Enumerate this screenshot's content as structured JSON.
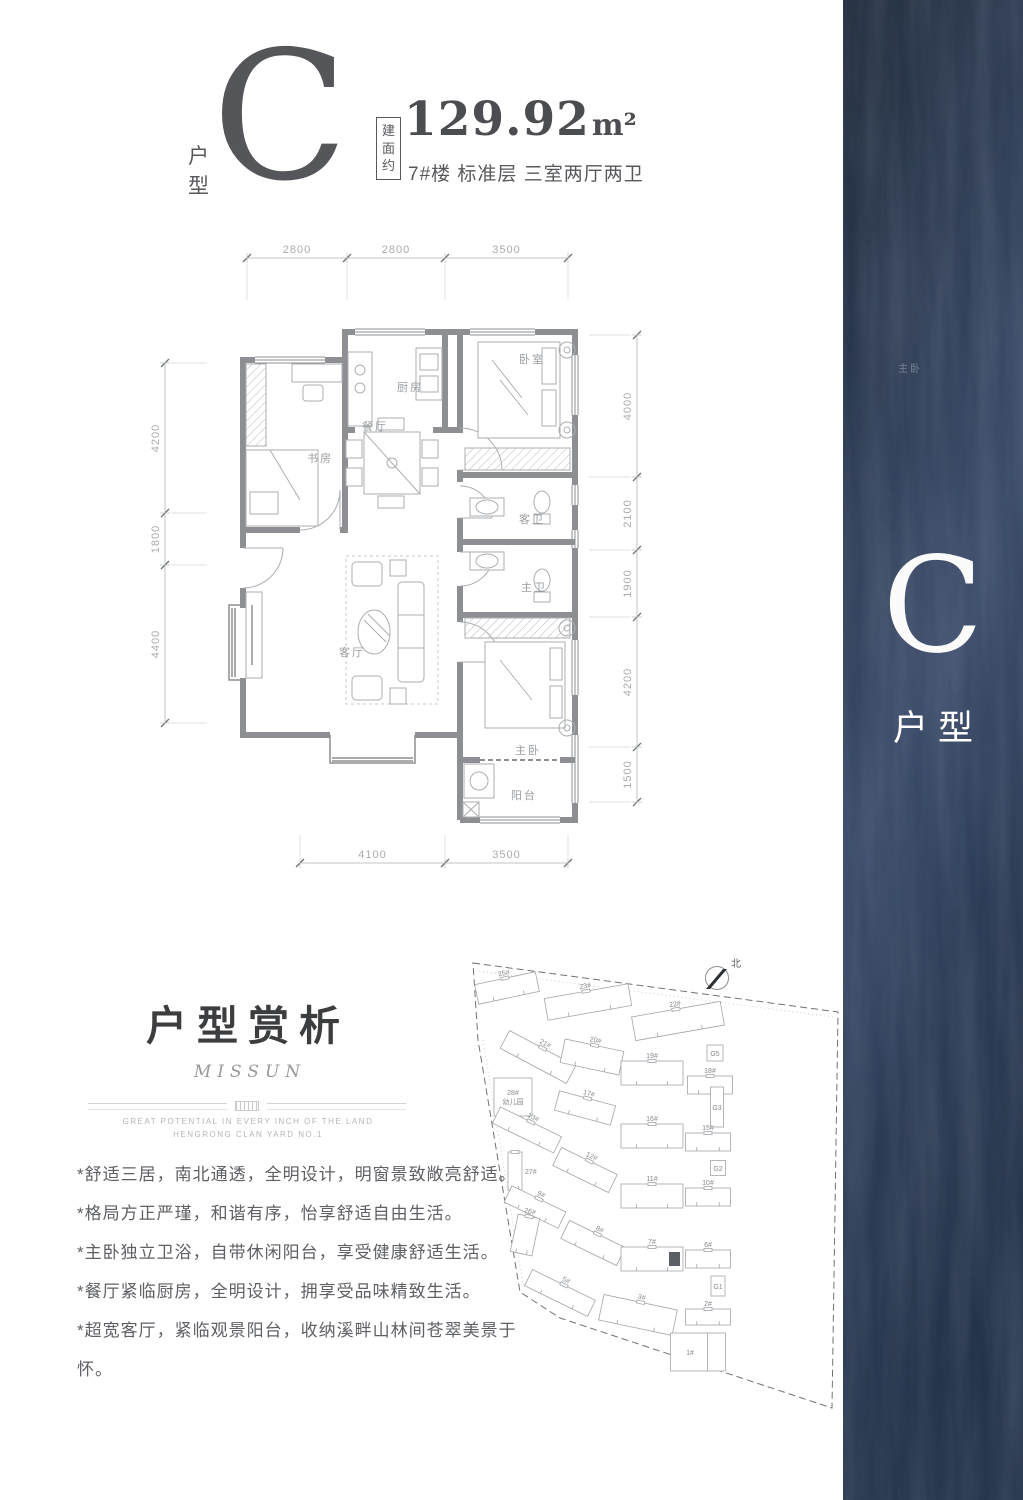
{
  "header": {
    "unit_type_label": "户型",
    "unit_letter": "C",
    "area_box_label": "建面约",
    "area_value": "129.92",
    "area_unit": "m²",
    "building_info": "7#楼 标准层 三室两厅两卫"
  },
  "floor_plan": {
    "rooms": [
      {
        "name": "study",
        "label": "书房",
        "x": 180,
        "y": 232
      },
      {
        "name": "dining",
        "label": "餐厅",
        "x": 235,
        "y": 200
      },
      {
        "name": "kitchen",
        "label": "厨房",
        "x": 270,
        "y": 161
      },
      {
        "name": "bedroom",
        "label": "卧室",
        "x": 392,
        "y": 133
      },
      {
        "name": "guest-bath",
        "label": "客卫",
        "x": 392,
        "y": 293
      },
      {
        "name": "master-bath",
        "label": "主卫",
        "x": 394,
        "y": 361
      },
      {
        "name": "living",
        "label": "客厅",
        "x": 212,
        "y": 426
      },
      {
        "name": "master-bedroom",
        "label": "主卧",
        "x": 388,
        "y": 524
      },
      {
        "name": "balcony",
        "label": "阳台",
        "x": 384,
        "y": 569
      }
    ],
    "dimensions": {
      "top": {
        "orientation": "h",
        "pos": 28,
        "ticks": [
          107,
          207,
          305,
          428
        ],
        "labels": [
          "2800",
          "2800",
          "3500"
        ],
        "ext": 42
      },
      "bottom": {
        "orientation": "h",
        "pos": 633,
        "ticks": [
          160,
          305,
          428
        ],
        "labels": [
          "4100",
          "3500"
        ],
        "ext": -28
      },
      "left": {
        "orientation": "v",
        "pos": 25,
        "ticks": [
          133,
          283,
          335,
          493
        ],
        "labels": [
          "4200",
          "1800",
          "4400"
        ],
        "ext": 42
      },
      "right": {
        "orientation": "v",
        "pos": 497,
        "ticks": [
          105,
          247,
          320,
          387,
          517,
          572
        ],
        "labels": [
          "4000",
          "2100",
          "1900",
          "4200",
          "1500"
        ],
        "ext": -48
      }
    }
  },
  "appreciation": {
    "title": "户型赏析",
    "brand": "MISSUN",
    "tagline1": "GREAT POTENTIAL IN EVERY INCH OF THE LAND",
    "tagline2": "HENGRONG CLAN YARD NO.1",
    "bullets": [
      "*舒适三居，南北通透，全明设计，明窗景致敞亮舒适。",
      "*格局方正严瑾，和谐有序，怡享舒适自由生活。",
      "*主卧独立卫浴，自带休闲阳台，享受健康舒适生活。",
      "*餐厅紧临厨房，全明设计，拥享受品味精致生活。",
      "*超宽客厅，紧临观景阳台，收纳溪畔山林间苍翠美景于怀。"
    ]
  },
  "site_plan": {
    "north_label": "北",
    "buildings": [
      {
        "label": "25#",
        "cx": 52,
        "cy": 43,
        "w": 62,
        "h": 20,
        "rot": -12
      },
      {
        "label": "23#",
        "cx": 133,
        "cy": 57,
        "w": 85,
        "h": 22,
        "rot": -10
      },
      {
        "label": "22#",
        "cx": 223,
        "cy": 76,
        "w": 90,
        "h": 24,
        "rot": -10
      },
      {
        "label": "G5",
        "cx": 260,
        "cy": 108,
        "w": 16,
        "h": 16,
        "rot": 0,
        "kind": "box"
      },
      {
        "label": "21#",
        "cx": 83,
        "cy": 112,
        "w": 75,
        "h": 20,
        "rot": 28
      },
      {
        "label": "20#",
        "cx": 137,
        "cy": 112,
        "w": 60,
        "h": 24,
        "rot": 12
      },
      {
        "label": "19#",
        "cx": 197,
        "cy": 128,
        "w": 62,
        "h": 24,
        "rot": 0
      },
      {
        "label": "18#",
        "cx": 255,
        "cy": 140,
        "w": 45,
        "h": 18,
        "rot": 0
      },
      {
        "label": "28#",
        "label2": "幼儿园",
        "cx": 58,
        "cy": 152,
        "w": 38,
        "h": 38,
        "rot": 0,
        "kind": "block"
      },
      {
        "label": "17#",
        "cx": 130,
        "cy": 163,
        "w": 58,
        "h": 20,
        "rot": 15
      },
      {
        "label": "G3",
        "cx": 262,
        "cy": 162,
        "w": 13,
        "h": 40,
        "rot": 0,
        "kind": "box"
      },
      {
        "label": "13#",
        "cx": 72,
        "cy": 185,
        "w": 68,
        "h": 18,
        "rot": 26
      },
      {
        "label": "16#",
        "cx": 197,
        "cy": 191,
        "w": 62,
        "h": 24,
        "rot": 0
      },
      {
        "label": "15#",
        "cx": 253,
        "cy": 197,
        "w": 45,
        "h": 18,
        "rot": 0
      },
      {
        "label": "27#",
        "cx": 60,
        "cy": 226,
        "w": 14,
        "h": 38,
        "rot": 0,
        "labelSide": "right"
      },
      {
        "label": "12#",
        "cx": 130,
        "cy": 225,
        "w": 62,
        "h": 20,
        "rot": 26
      },
      {
        "label": "G2",
        "cx": 263,
        "cy": 223,
        "w": 15,
        "h": 15,
        "rot": 0,
        "kind": "box"
      },
      {
        "label": "11#",
        "cx": 197,
        "cy": 251,
        "w": 62,
        "h": 24,
        "rot": 0
      },
      {
        "label": "10#",
        "cx": 253,
        "cy": 252,
        "w": 45,
        "h": 18,
        "rot": 0
      },
      {
        "label": "9#",
        "cx": 80,
        "cy": 262,
        "w": 60,
        "h": 18,
        "rot": 26
      },
      {
        "label": "26#",
        "cx": 70,
        "cy": 290,
        "w": 22,
        "h": 38,
        "rot": 12
      },
      {
        "label": "8#",
        "cx": 138,
        "cy": 298,
        "w": 62,
        "h": 20,
        "rot": 26
      },
      {
        "label": "7#",
        "cx": 197,
        "cy": 314,
        "w": 62,
        "h": 24,
        "rot": 0,
        "highlight": true
      },
      {
        "label": "6#",
        "cx": 253,
        "cy": 314,
        "w": 45,
        "h": 18,
        "rot": 0
      },
      {
        "label": "G1",
        "cx": 263,
        "cy": 341,
        "w": 14,
        "h": 20,
        "rot": 0,
        "kind": "box"
      },
      {
        "label": "5#",
        "cx": 105,
        "cy": 348,
        "w": 70,
        "h": 18,
        "rot": 26
      },
      {
        "label": "3#",
        "cx": 183,
        "cy": 370,
        "w": 75,
        "h": 26,
        "rot": 12
      },
      {
        "label": "2#",
        "cx": 253,
        "cy": 372,
        "w": 45,
        "h": 16,
        "rot": 0
      },
      {
        "label": "1#",
        "cx": 243,
        "cy": 407,
        "w": 55,
        "h": 38,
        "rot": 0,
        "kind": "big"
      }
    ]
  },
  "banner": {
    "unit_letter": "C",
    "unit_type_label": "户型",
    "watermark": "主卧"
  },
  "colors": {
    "wall": "#8d8f92",
    "banner_bg": "#2c3a56",
    "header_text": "#57585b"
  }
}
